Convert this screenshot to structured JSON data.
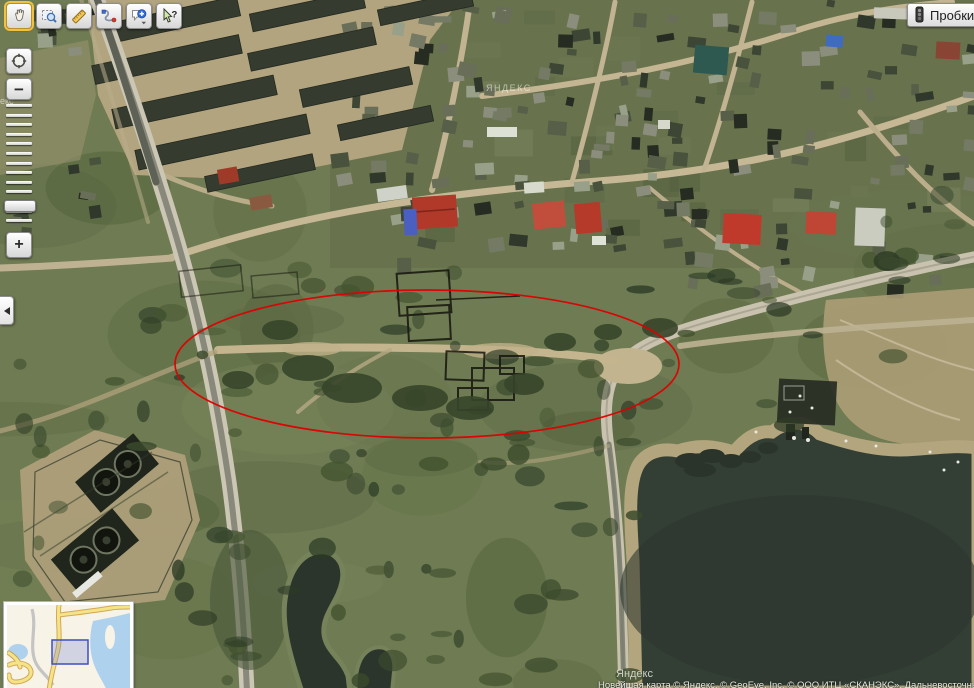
{
  "window": {
    "width": 974,
    "height": 688,
    "app": "satellite-map-view"
  },
  "toolbar": {
    "buttons": [
      {
        "name": "pan-tool",
        "icon": "hand-icon",
        "active": true
      },
      {
        "name": "magnifier-select",
        "icon": "zoom-select-icon",
        "active": false
      },
      {
        "name": "ruler",
        "icon": "ruler-icon",
        "active": false
      },
      {
        "name": "route",
        "icon": "route-icon",
        "active": false
      },
      {
        "name": "add-placemark",
        "icon": "comment-plus-icon",
        "active": false,
        "has_dropdown": true
      },
      {
        "name": "whats-here",
        "icon": "help-cursor-icon",
        "active": false
      }
    ],
    "help_glyph": "?"
  },
  "traffic_button": {
    "label": "Пробки",
    "icon": "traffic-light-icon"
  },
  "zoom_control": {
    "zoom_in_label": "+",
    "zoom_out_label": "−",
    "tick_count": 13,
    "handle_position": "near-bottom",
    "locate_icon": "crosshair-circle-icon"
  },
  "collapse_tab": {
    "direction": "left"
  },
  "map": {
    "type": "satellite",
    "watermark_center": "ЯНДЕКС",
    "watermark_bottom": "Яндекс",
    "watermark_left": "екс",
    "copyright": "Новейшая карта © Яндекс, © GeoEye, Inc. © ООО ИТЦ «СКАНЭКС», Дальневосточный",
    "annotation_ellipse": {
      "cx": 427,
      "cy": 364,
      "rx": 252,
      "ry": 74,
      "color": "#dd0000"
    }
  },
  "minimap": {
    "viewport": {
      "x": 45,
      "y": 35,
      "w": 36,
      "h": 24
    },
    "water_color": "#aed2ee",
    "road_color": "#f4e488"
  }
}
